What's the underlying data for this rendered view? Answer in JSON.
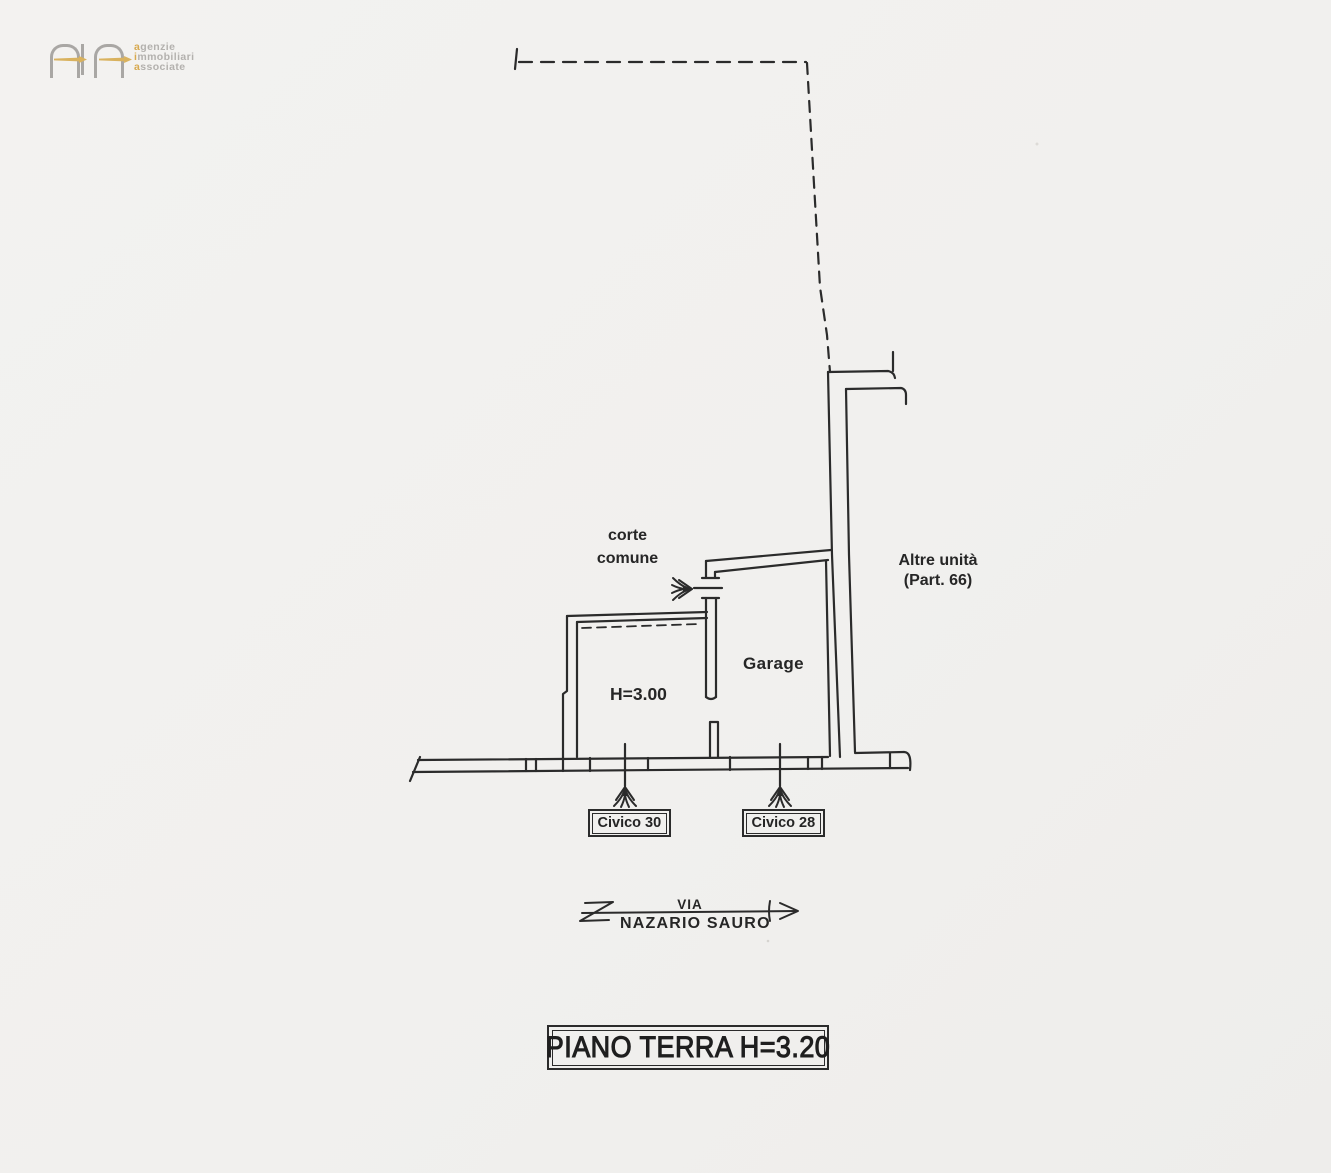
{
  "page": {
    "paper_color": "#f1f0ee",
    "ink_color": "#2b2b2b"
  },
  "logo": {
    "accent_color": "#d7a94f",
    "mark_color": "#a9a7a4",
    "words": [
      {
        "initial": "a",
        "rest": "genzie"
      },
      {
        "initial": "i",
        "rest": "mmobiliari"
      },
      {
        "initial": "a",
        "rest": "ssociate"
      }
    ]
  },
  "plan": {
    "court_label": {
      "line1": "corte",
      "line2": "comune"
    },
    "garage_label": "Garage",
    "room_height_label": "H=3.00",
    "other_unit_label": {
      "line1": "Altre unità",
      "line2": "(Part. 66)"
    },
    "entrance_30_label": "Civico 30",
    "entrance_28_label": "Civico 28"
  },
  "street": {
    "line1": "VIA",
    "line2": "NAZARIO SAURO"
  },
  "title_box": {
    "text": "PIANO TERRA H=3.20"
  },
  "icons": {
    "entrance_arrow": "feathered-arrow",
    "road_break": "zigzag-break-symbol",
    "road_arrow": "open-arrowhead"
  }
}
